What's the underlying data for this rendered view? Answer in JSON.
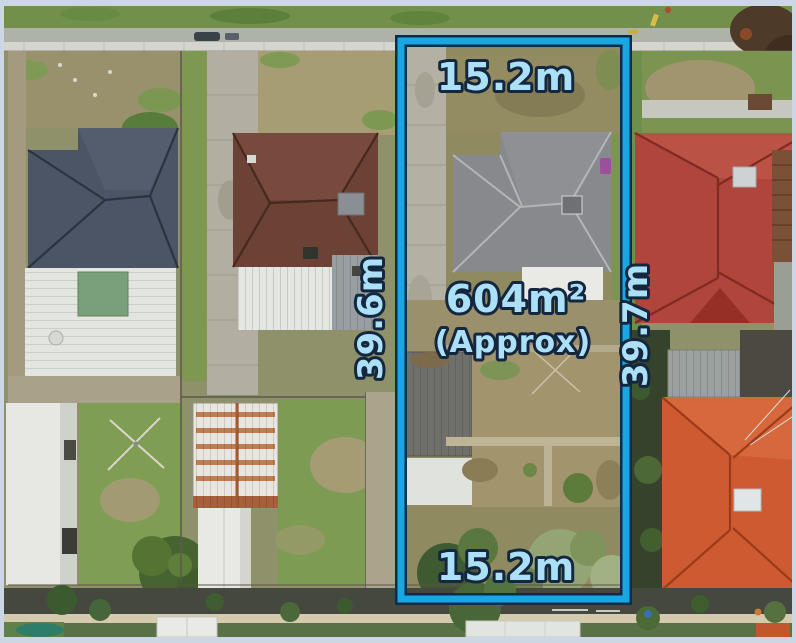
{
  "boundary_labels": {
    "top_width": "15.2m",
    "bottom_width": "15.2m",
    "left_depth": "39.6m",
    "right_depth": "39.7m",
    "area": "604m²",
    "area_qualifier": "(Approx)"
  },
  "colors": {
    "boundary_blue": "#18a7e2",
    "boundary_outline_dark": "#0d2c4a",
    "label_text_fill": "#ace0f6",
    "label_text_outline": "#15273f",
    "photo_frame": "#cdd7e3"
  }
}
